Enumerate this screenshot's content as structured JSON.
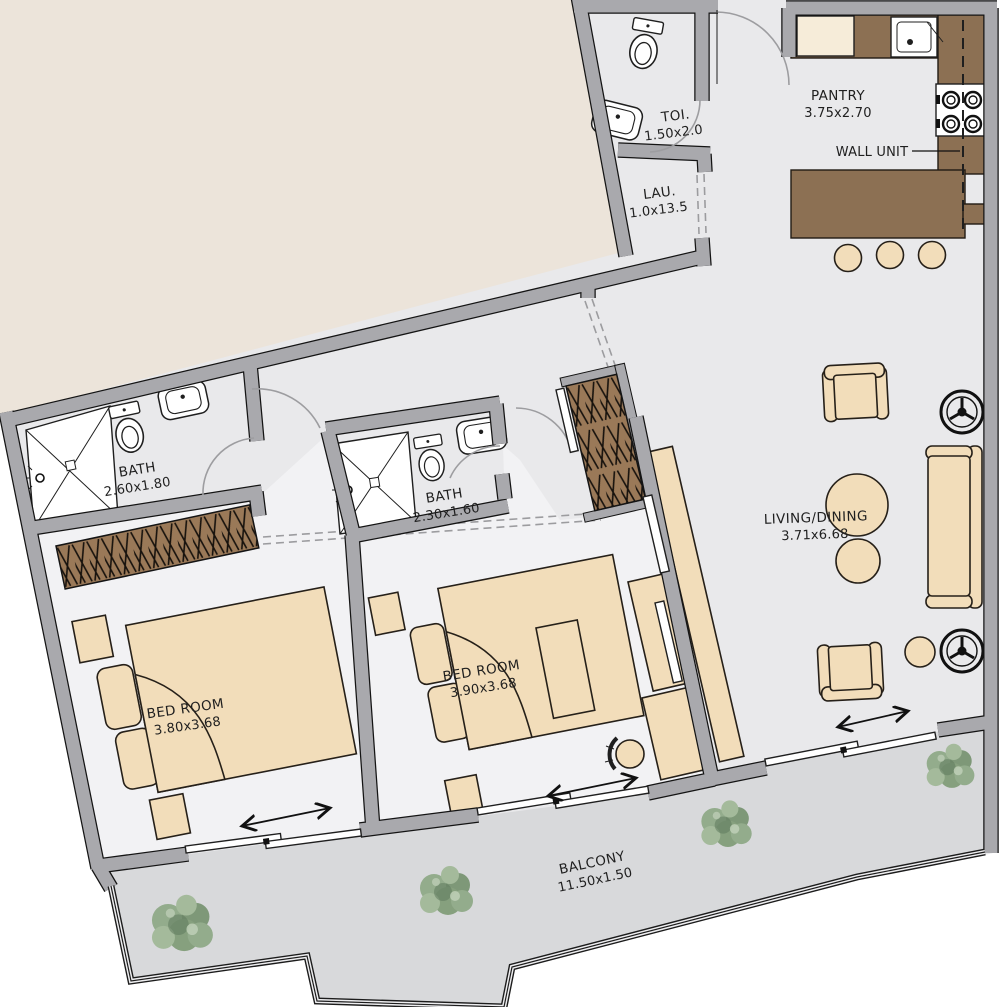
{
  "rooms": {
    "toi": {
      "name": "TOI.",
      "dims": "1.50x2.0"
    },
    "lau": {
      "name": "LAU.",
      "dims": "1.0x13.5"
    },
    "pantry": {
      "name": "PANTRY",
      "dims": "3.75x2.70"
    },
    "bath1": {
      "name": "BATH",
      "dims": "2.60x1.80"
    },
    "bath2": {
      "name": "BATH",
      "dims": "2.30x1.60"
    },
    "living": {
      "name": "LIVING/DINING",
      "dims": "3.71x6.68"
    },
    "bed1": {
      "name": "BED ROOM",
      "dims": "3.80x3.68"
    },
    "bed2": {
      "name": "BED ROOM",
      "dims": "3.90x3.68"
    },
    "balcony": {
      "name": "BALCONY",
      "dims": "11.50x1.50"
    }
  },
  "annotations": {
    "wall_unit": "WALL UNIT"
  },
  "colors": {
    "outside_beige": "#ece4da",
    "floor": "#e9e9eb",
    "balcony_floor": "#d8d9db",
    "wall": "#a9a9ad",
    "furniture_tan": "#f2ddba",
    "counter_brown": "#8c7053",
    "wardrobe_brown": "#9a7958",
    "tree_green": "#8ea888",
    "text": "#1f1f1f"
  }
}
